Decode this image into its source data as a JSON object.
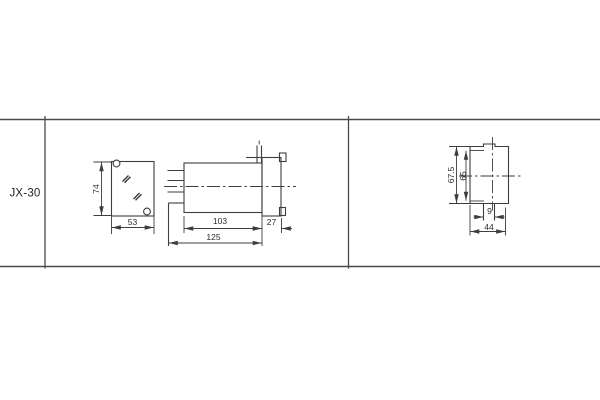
{
  "drawing": {
    "model": "JX-30",
    "views": {
      "front": {
        "height": "74",
        "width": "53"
      },
      "side": {
        "body_depth": "103",
        "flange_depth": "27",
        "overall_depth": "125"
      },
      "end": {
        "overall_height": "67.5",
        "inner_height": "65",
        "slot_width": "9",
        "width": "44"
      }
    },
    "colors": {
      "line": "#3d3d3d",
      "grid_rule": "#4a4a4a",
      "text": "#2b2b2b",
      "background": "#ffffff"
    }
  }
}
